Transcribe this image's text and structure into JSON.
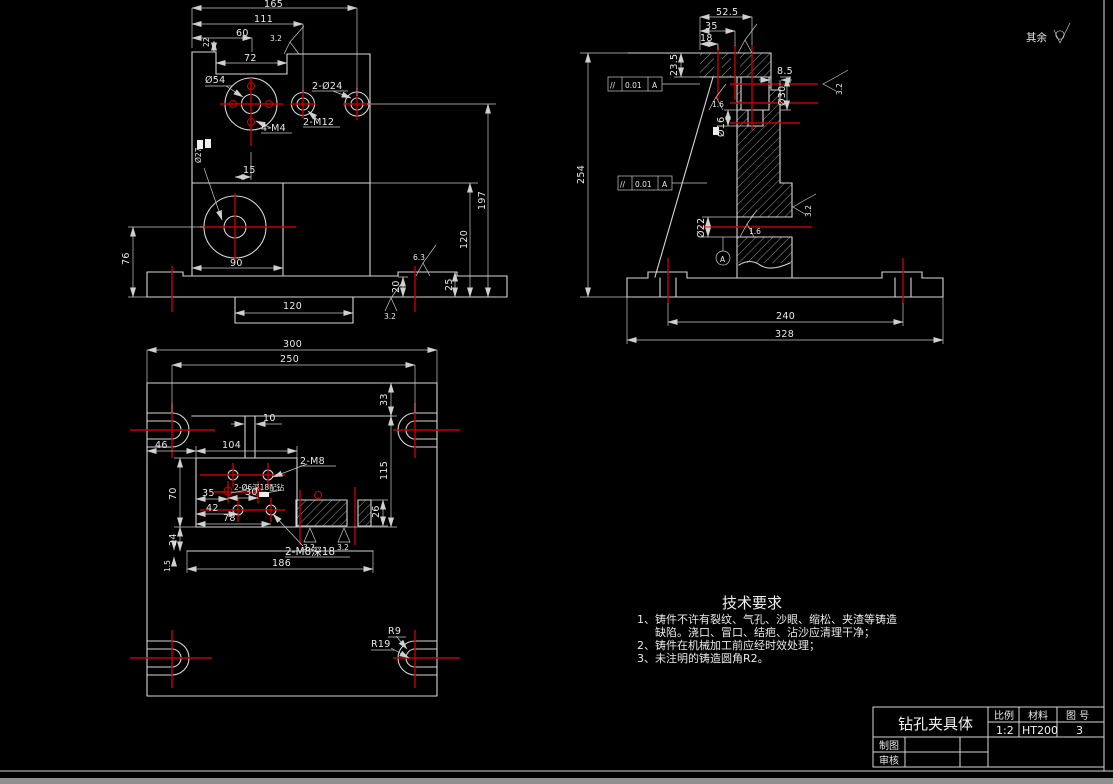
{
  "palette": {
    "background": "#000000",
    "outline": "#d6d6d6",
    "dimension": "#c9c9c9",
    "centerline": "#c30000",
    "text": "#e8e8e8"
  },
  "corner": {
    "note": "其余"
  },
  "front": {
    "d165": "165",
    "d111": "111",
    "d60": "60",
    "d22": "22",
    "d72": "72",
    "f32top": "3.2",
    "dia54": "Ø54",
    "d2dia24": "2-Ø24",
    "d2m12": "2-M12",
    "d4m4": "4-M4",
    "dia27": "Ø27",
    "d15": "15",
    "d90": "90",
    "d76": "76",
    "d120pad": "120",
    "d20": "20",
    "f32bot": "3.2",
    "f63": "6.3",
    "d25": "25",
    "d120r": "120",
    "d197": "197"
  },
  "side": {
    "d525": "52.5",
    "d35": "35",
    "d18": "18",
    "d235": "23.5",
    "d85": "8.5",
    "tol1": {
      "sym": "//",
      "val": "0.01",
      "ref": "A"
    },
    "tol2": {
      "sym": "//",
      "val": "0.01",
      "ref": "A"
    },
    "dia30": "Ø30",
    "dia16": "Ø16",
    "dia22": "Ø22",
    "f16a": "1.6",
    "f16b": "1.6",
    "f32a": "3.2",
    "f32b": "3.2",
    "datum": "A",
    "d254": "254",
    "d240": "240",
    "d328": "328"
  },
  "top": {
    "d300": "300",
    "d250": "250",
    "d33": "33",
    "d10": "10",
    "d46": "46",
    "d104": "104",
    "m8": "2-M8",
    "d115": "115",
    "pin": "2-Ø6深18配钻",
    "d35": "35",
    "d30": "30",
    "d42": "42",
    "d78": "78",
    "d70": "70",
    "d26": "26",
    "d24": "24",
    "m8deep": "2-M8深18",
    "d15": "1.5",
    "d186": "186",
    "f32a": "3.2",
    "f32b": "3.2",
    "r9": "R9",
    "r19": "R19"
  },
  "tech": {
    "title": "技术要求",
    "l1": "1、铸件不许有裂纹、气孔、沙眼、缩松、夹渣等铸造",
    "l2": "缺陷。浇口、冒口、结疤、沾沙应清理干净；",
    "l3": "2、铸件在机械加工前应经时效处理；",
    "l4": "3、未注明的铸造圆角R2。"
  },
  "tb": {
    "name": "钻孔夹具体",
    "scale_l": "比例",
    "mat_l": "材料",
    "no_l": "图 号",
    "scale_v": "1:2",
    "mat_v": "HT200",
    "no_v": "3",
    "draw_l": "制图",
    "check_l": "审核"
  }
}
